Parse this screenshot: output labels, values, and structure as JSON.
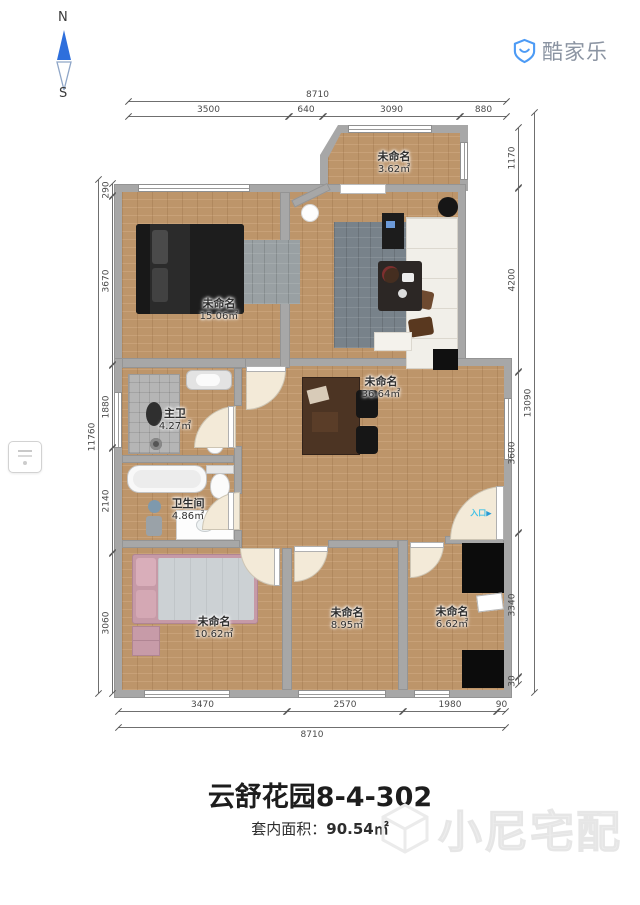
{
  "compass": {
    "north": "N",
    "south": "S"
  },
  "logo": {
    "brand": "酷家乐"
  },
  "plan": {
    "rooms": [
      {
        "name": "未命名",
        "area": "3.62㎡"
      },
      {
        "name": "未命名",
        "area": "15.06㎡"
      },
      {
        "name": "未命名",
        "area": "36.64㎡"
      },
      {
        "name": "主卫",
        "area": "4.27㎡"
      },
      {
        "name": "卫生间",
        "area": "4.86㎡"
      },
      {
        "name": "未命名",
        "area": "10.62㎡"
      },
      {
        "name": "未命名",
        "area": "8.95㎡"
      },
      {
        "name": "未命名",
        "area": "6.62㎡"
      }
    ],
    "entrance_label": "入口"
  },
  "dimensions": {
    "top": {
      "total": "8710",
      "segments": [
        "3500",
        "640",
        "3090",
        "880"
      ]
    },
    "bottom": {
      "total": "8710",
      "segments": [
        "3470",
        "2570",
        "1980",
        "90"
      ]
    },
    "left": {
      "total": "11760",
      "segments": [
        "290",
        "3670",
        "1880",
        "2140",
        "3060"
      ]
    },
    "right": {
      "total": "13090",
      "segments": [
        "1170",
        "4200",
        "3600",
        "3340",
        "30"
      ]
    }
  },
  "footer": {
    "title": "云舒花园8-4-302",
    "area_label": "套内面积：",
    "area_value": "90.54㎡"
  },
  "watermark": {
    "text": "小尼宅配"
  },
  "colors": {
    "wood": "#c49a6e",
    "wall": "#a7a7a7",
    "brand_blue": "#4d9bf5",
    "entrance_cyan": "#3ec0e6"
  }
}
